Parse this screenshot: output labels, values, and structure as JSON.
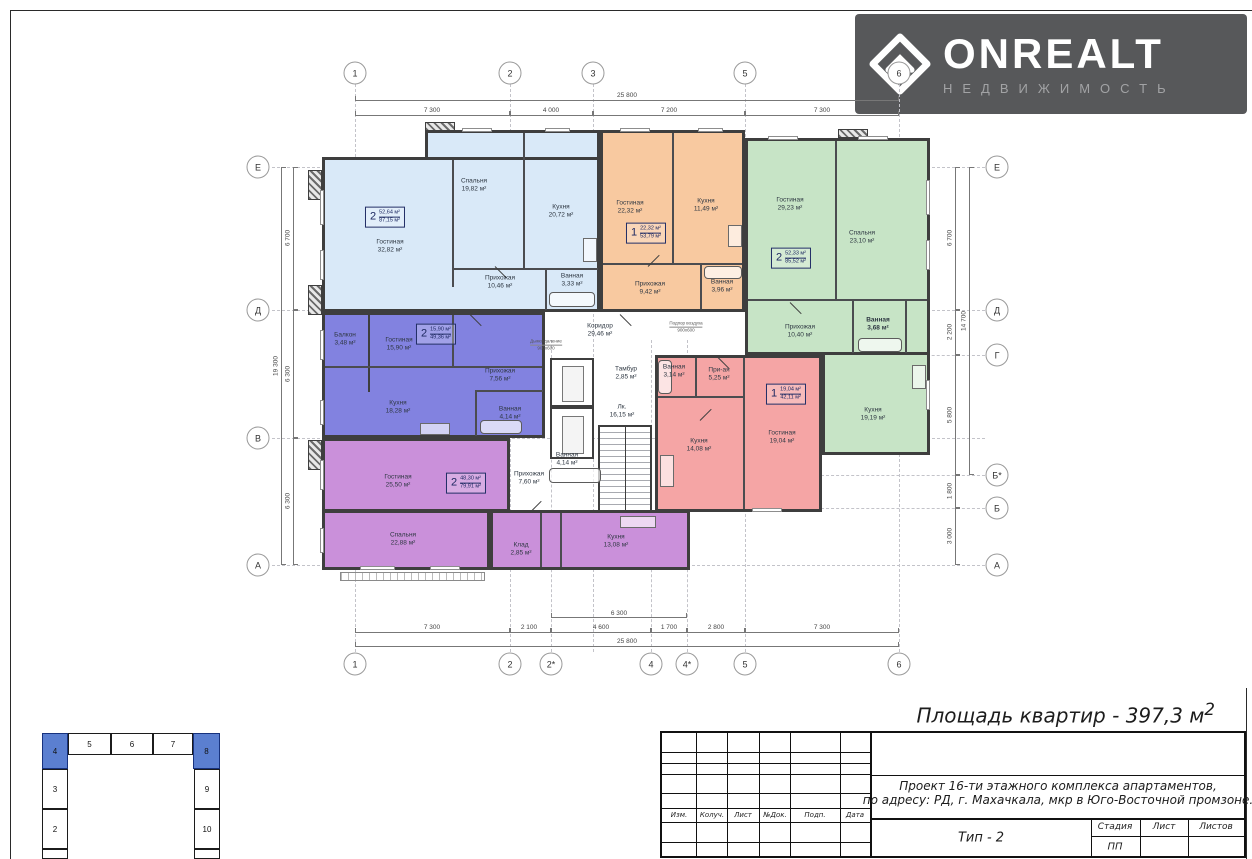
{
  "logo": {
    "name": "ONREALT",
    "sub": "НЕДВИЖИМОСТЬ"
  },
  "summary": {
    "total_area": "Площадь квартир - 397,3 м",
    "exp": "2"
  },
  "colors": {
    "lightblue": "#d9e9f8",
    "orange": "#f8c9a0",
    "green": "#c7e4c6",
    "violet": "#8282e0",
    "purple": "#ca90da",
    "pink": "#f5a5a5",
    "wall": "#3e3e3e",
    "keyplan_blue": "#5b7fd0",
    "logo_bg": "#57585a"
  },
  "axes": {
    "top": [
      "1",
      "2",
      "3",
      "5",
      "6"
    ],
    "bottom": [
      "1",
      "2",
      "2*",
      "4",
      "4*",
      "5",
      "6"
    ],
    "left": [
      "Е",
      "Д",
      "В",
      "А"
    ],
    "right": [
      "Е",
      "Д",
      "Г",
      "Б*",
      "Б",
      "А"
    ]
  },
  "dims": {
    "top_total": "25 800",
    "top_segs": [
      "7 300",
      "4 000",
      "7 200",
      "7 300"
    ],
    "bottom_total": "25 800",
    "bottom_mid": "6 300",
    "bottom_segs": [
      "7 300",
      "2 100",
      "4 600",
      "1 700",
      "2 800",
      "7 300"
    ],
    "left_total": "19 300",
    "left_segs": [
      "6 700",
      "6 300",
      "6 300"
    ],
    "right_inner": "14 700",
    "right_segs": [
      "6 700",
      "2 200",
      "5 800",
      "1 800",
      "3 000"
    ]
  },
  "apartments": {
    "lightblue": {
      "badge_num": "2",
      "badge_top": "52,64 м²",
      "badge_bot": "87,15 м²",
      "rooms": {
        "living": {
          "n": "Гостиная",
          "a": "32,82 м²"
        },
        "bedroom": {
          "n": "Спальня",
          "a": "19,82 м²"
        },
        "kitchen": {
          "n": "Кухня",
          "a": "20,72 м²"
        },
        "hall": {
          "n": "Прихожая",
          "a": "10,46 м²"
        },
        "bath": {
          "n": "Ванная",
          "a": "3,33 м²"
        }
      }
    },
    "orange": {
      "badge_num": "1",
      "badge_top": "22,32 м²",
      "badge_bot": "53,79 м²",
      "rooms": {
        "living": {
          "n": "Гостиная",
          "a": "22,32 м²"
        },
        "kitchen": {
          "n": "Кухня",
          "a": "11,49 м²"
        },
        "hall": {
          "n": "Прихожая",
          "a": "9,42 м²"
        },
        "bath": {
          "n": "Ванная",
          "a": "3,96 м²"
        }
      }
    },
    "green": {
      "badge_num": "2",
      "badge_top": "52,33 м²",
      "badge_bot": "85,52 м²",
      "rooms": {
        "living": {
          "n": "Гостиная",
          "a": "29,23 м²"
        },
        "bedroom": {
          "n": "Спальня",
          "a": "23,10 м²"
        },
        "hall": {
          "n": "Прихожая",
          "a": "10,40 м²"
        },
        "bath": {
          "n": "Ванная",
          "a": "3,68 м²"
        },
        "kitchen": {
          "n": "Кухня",
          "a": "19,19 м²"
        }
      }
    },
    "violet": {
      "badge_num": "2",
      "badge_top": "15,90 м²",
      "badge_bot": "49,36 м²",
      "rooms": {
        "balcony": {
          "n": "Балкон",
          "a": "3,48 м²"
        },
        "living": {
          "n": "Гостиная",
          "a": "15,90 м²"
        },
        "hall": {
          "n": "Прихожая",
          "a": "7,56 м²"
        },
        "kitchen": {
          "n": "Кухня",
          "a": "18,28 м²"
        },
        "bath": {
          "n": "Ванная",
          "a": "4,14 м²"
        }
      }
    },
    "purple": {
      "badge_num": "2",
      "badge_top": "48,30 м²",
      "badge_bot": "79,91 м²",
      "rooms": {
        "living": {
          "n": "Гостиная",
          "a": "25,50 м²"
        },
        "bedroom": {
          "n": "Спальня",
          "a": "22,88 м²"
        },
        "hall": {
          "n": "Прихожая",
          "a": "7,60 м²"
        },
        "bath": {
          "n": "Ванная",
          "a": "4,14 м²"
        },
        "storage": {
          "n": "Клад",
          "a": "2,85 м²"
        },
        "kitchen": {
          "n": "Кухня",
          "a": "13,08 м²"
        }
      }
    },
    "pink": {
      "badge_num": "1",
      "badge_top": "19,04 м²",
      "badge_bot": "42,11 м²",
      "rooms": {
        "bath": {
          "n": "Ванная",
          "a": "3,14 м²"
        },
        "hall": {
          "n": "При-ая",
          "a": "5,25 м²"
        },
        "living": {
          "n": "Гостиная",
          "a": "19,04 м²"
        },
        "kitchen": {
          "n": "Кухня",
          "a": "14,08 м²"
        }
      }
    }
  },
  "core": {
    "corridor": {
      "n": "Коридор",
      "a": "29,46 м²"
    },
    "tambour": {
      "n": "Тамбур",
      "a": "2,85 м²"
    },
    "stairs": {
      "n": "Лк.",
      "a": "16,15 м²"
    },
    "smoke": {
      "n": "Дымоудаление",
      "s": "900х600"
    },
    "air": {
      "n": "Подпор воздуха",
      "s": "900х600"
    }
  },
  "keyplan": {
    "top": [
      "4",
      "5",
      "6",
      "7",
      "8"
    ],
    "left": [
      "3",
      "2"
    ],
    "right": [
      "9",
      "10"
    ]
  },
  "titleblock": {
    "project_line1": "Проект 16-ти этажного комплекса апартаментов,",
    "project_line2": "по адресу: РД, г. Махачкала, мкр в Юго-Восточной промзоне.",
    "type": "Тип - 2",
    "stage_label": "Стадия",
    "sheet_label": "Лист",
    "sheets_label": "Листов",
    "stage_value": "ПП",
    "stamp_cols": [
      "Изм.",
      "Колуч.",
      "Лист",
      "№Док.",
      "Подп.",
      "Дата"
    ]
  }
}
